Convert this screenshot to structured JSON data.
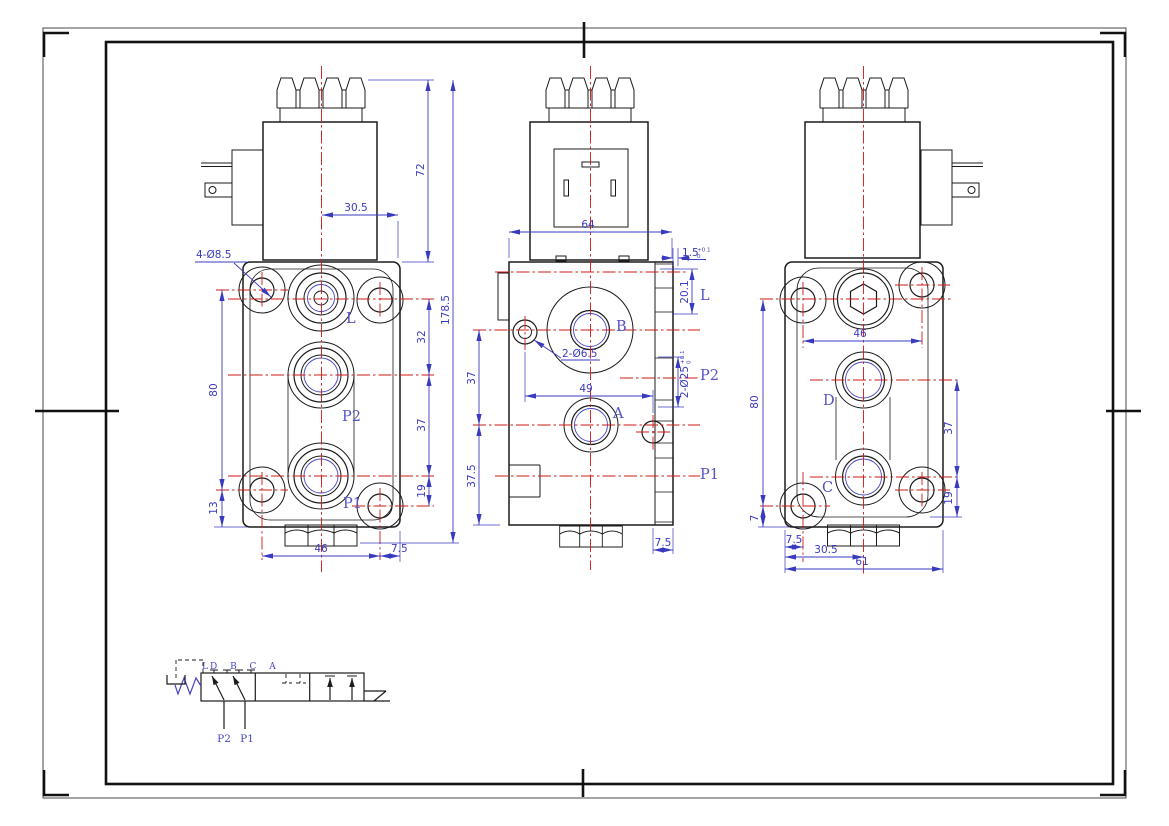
{
  "front": {
    "label_l": "L",
    "label_p2": "P2",
    "label_p1": "P1",
    "note_holes": "4-Ø8.5",
    "dim_305": "30.5",
    "dim_72": "72",
    "dim_1785": "178.5",
    "dim_32": "32",
    "dim_37": "37",
    "dim_19": "19",
    "dim_80": "80",
    "dim_13": "13",
    "dim_46": "46",
    "dim_75": "7.5"
  },
  "section": {
    "label_l": "L",
    "label_b": "B",
    "label_a": "A",
    "label_p2": "P2",
    "label_p1": "P1",
    "dim_64": "64",
    "dim_15": "1.5",
    "dim_15_tol_up": "+0.1",
    "dim_15_tol_dn": "0",
    "dim_201": "20.1",
    "note_holes": "2-Ø6.5",
    "dim_49": "49",
    "note_ports": "2-Ø25",
    "note_ports_tol_up": "+0.1",
    "note_ports_tol_dn": "0",
    "dim_37": "37",
    "dim_375": "37.5",
    "dim_75": "7.5"
  },
  "rear": {
    "label_d": "D",
    "label_c": "C",
    "dim_46": "46",
    "dim_37": "37",
    "dim_19": "19",
    "dim_80": "80",
    "dim_7": "7",
    "dim_75": "7.5",
    "dim_305": "30.5",
    "dim_61": "61"
  },
  "schematic": {
    "label_l": "L",
    "ports_top": "D B C A",
    "label_p2": "P2",
    "label_p1": "P1"
  },
  "colors": {
    "outline": "#1b1b1b",
    "centerline": "#cf1717",
    "dimension": "#3a3ac0",
    "hatch": "#4646c8",
    "paper": "#ffffff"
  }
}
